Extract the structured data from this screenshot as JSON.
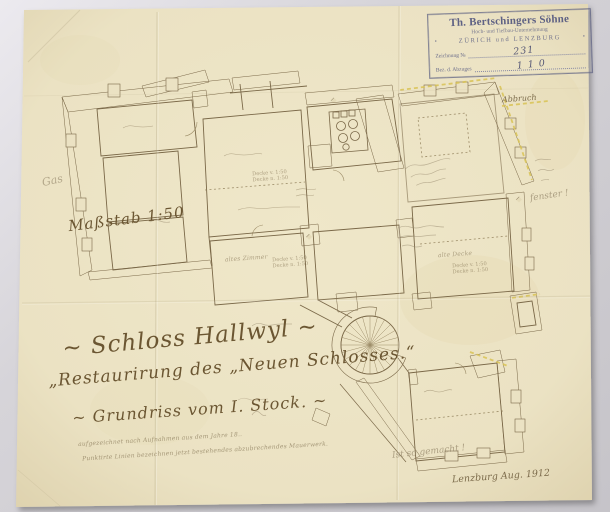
{
  "background_color": "#cbc9ce",
  "paper_color": "#ebe2c3",
  "stamp": {
    "company": "Th. Bertschingers Söhne",
    "subtitle": "Hoch- und Tiefbau-Unternehmung",
    "cities": "ZÜRICH und LENZBURG",
    "corner_glyph": "▪",
    "drawing_no_label": "Zeichnung №",
    "drawing_no_value": "231",
    "copy_label": "Bez. d. Abzuges",
    "copy_value": "1 1 0",
    "ink_color": "#5e6184"
  },
  "scale_label": "Maßstab 1:50",
  "title": {
    "line1": "~ Schloss Hallwyl ~",
    "line2": "„Restaurirung des „Neuen Schlosses.“",
    "line3": "~ Grundriss vom I. Stock. ~",
    "note1": "aufgezeichnet nach Aufnahmen aus dem Jahre 18..",
    "note2": "Punktirte Linien bezeichnen jetzt bestehendes abzubrechendes Mauerwerk."
  },
  "annotations": {
    "gas": "Gas",
    "abbruch": "Abbruch",
    "fenster": "fenster !",
    "so_gemacht": "Ist so gemacht !",
    "signature": "Lenzburg Aug. 1912"
  },
  "room_labels": {
    "mid_room": "altes Zimmer",
    "right_room": "alte Decke",
    "deck_note_a": "Decke v. 1:50",
    "deck_note_b": "Decke n. 1:50"
  },
  "drawing": {
    "ink_color": "#7a6848",
    "pencil_color": "#95876d",
    "highlight_color": "#d9c355"
  }
}
